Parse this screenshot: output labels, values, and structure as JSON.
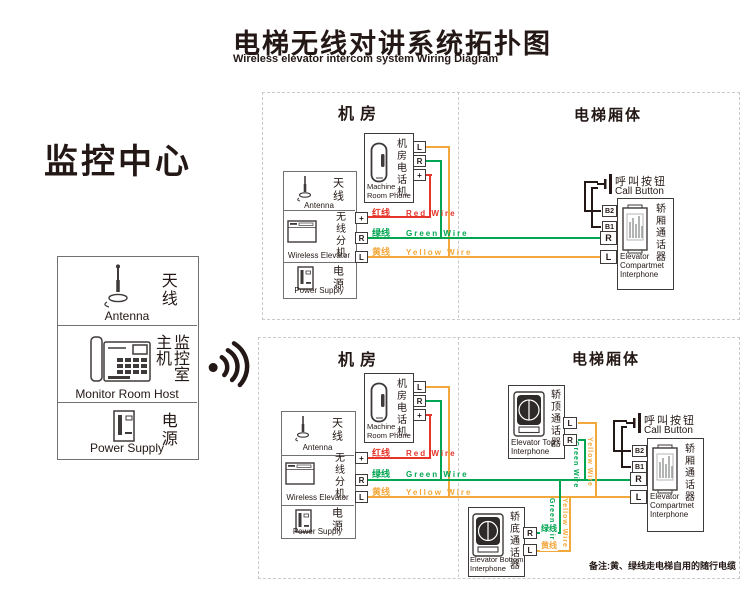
{
  "title": {
    "cn": "电梯无线对讲系统拓扑图",
    "en": "Wireless elevator intercom system Wiring Diagram"
  },
  "monitor": {
    "heading": "监控中心",
    "antenna_cn": "天线",
    "antenna_en": "Antenna",
    "host_cn": "监控室主机",
    "host_en": "Monitor Room Host",
    "power_cn": "电源",
    "power_en": "Power Supply"
  },
  "sections": {
    "machine_room": "机房",
    "elevator_car": "电梯厢体"
  },
  "devices": {
    "machine_phone_cn": "机房电话机",
    "machine_phone_en": "Machine Room Phone",
    "antenna_cn": "天线",
    "antenna_en": "Antenna",
    "wireless_cn": "无线分机",
    "wireless_en": "Wireless Elevator",
    "power_cn": "电源",
    "power_en": "Power Supply",
    "call_button_cn": "呼叫按钮",
    "call_button_en": "Call Button",
    "compartment_cn": "轿厢通话器",
    "compartment_en": "Elevator Compartmet Interphone",
    "top_interphone_cn": "轿顶通话器",
    "top_interphone_en": "Elevator Top Interphone",
    "bottom_interphone_cn": "轿底通话器",
    "bottom_interphone_en": "Elevator Bottom Interphone"
  },
  "wires": {
    "red": {
      "cn": "红线",
      "en": "Red Wire",
      "color": "#e5352b"
    },
    "green": {
      "cn": "绿线",
      "en": "Green Wire",
      "color": "#00a551"
    },
    "yellow": {
      "cn": "黄线",
      "en": "Yellow Wire",
      "color": "#f3a83c"
    }
  },
  "terminals": {
    "l": "L",
    "r": "R",
    "plus": "+",
    "b1": "B1",
    "b2": "B2"
  },
  "note": "备注:黄、绿线走电梯自用的随行电缆"
}
